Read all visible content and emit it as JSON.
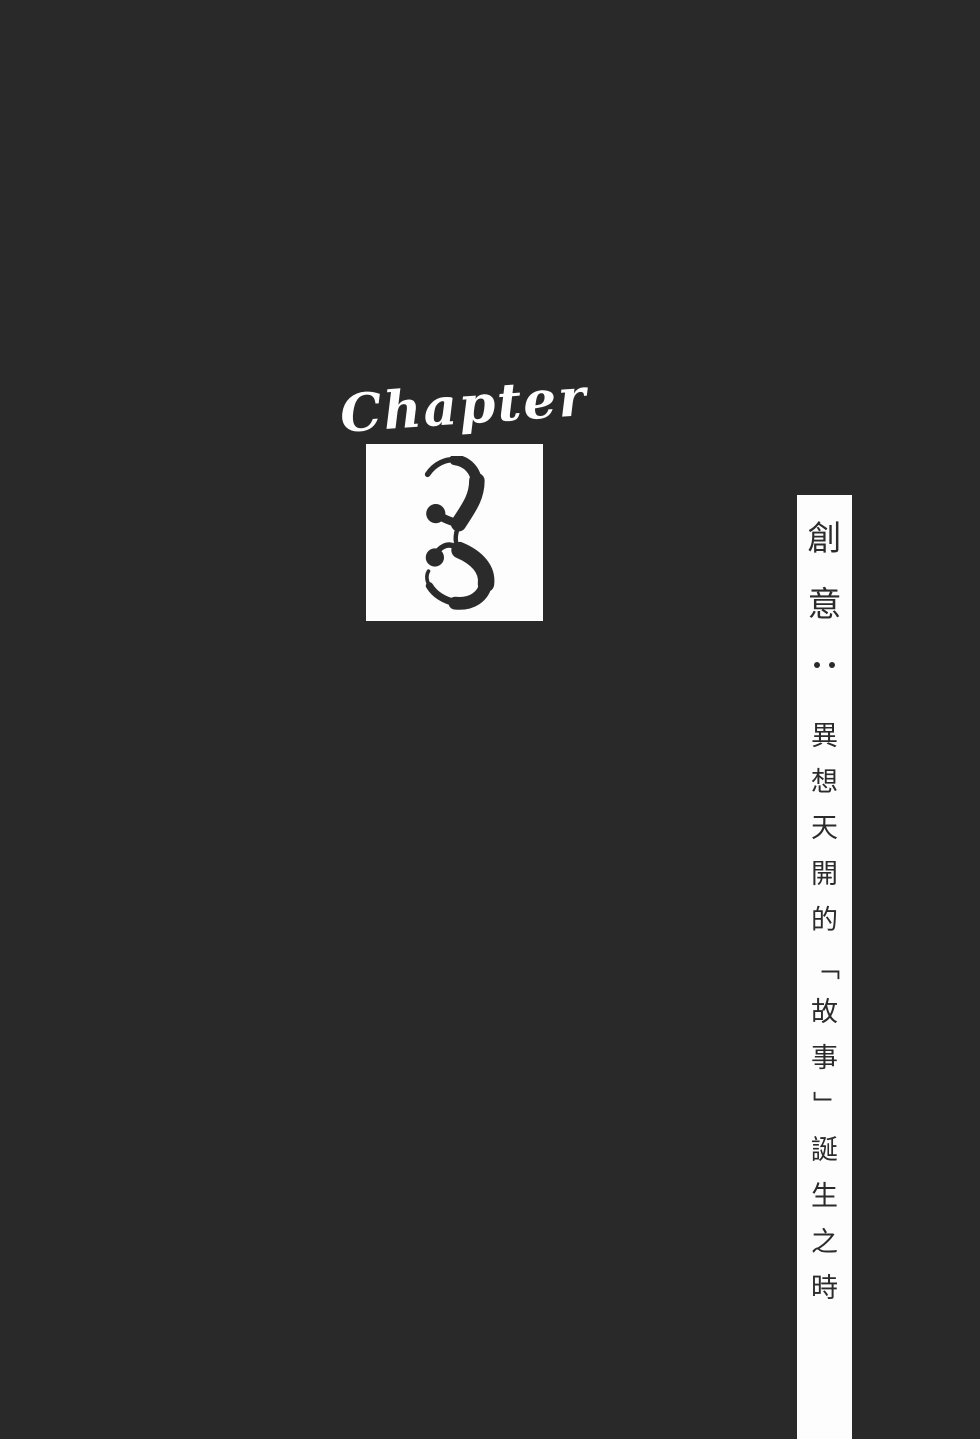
{
  "page": {
    "background_color": "#292929",
    "paper_color": "#fdfdfd",
    "ink_color": "#2b2b2b"
  },
  "chapter": {
    "label": "Chapter",
    "number": "3"
  },
  "side_title": {
    "title": "創意",
    "colon": "：",
    "subtitle": "異想天開的「故事」誕生之時"
  }
}
